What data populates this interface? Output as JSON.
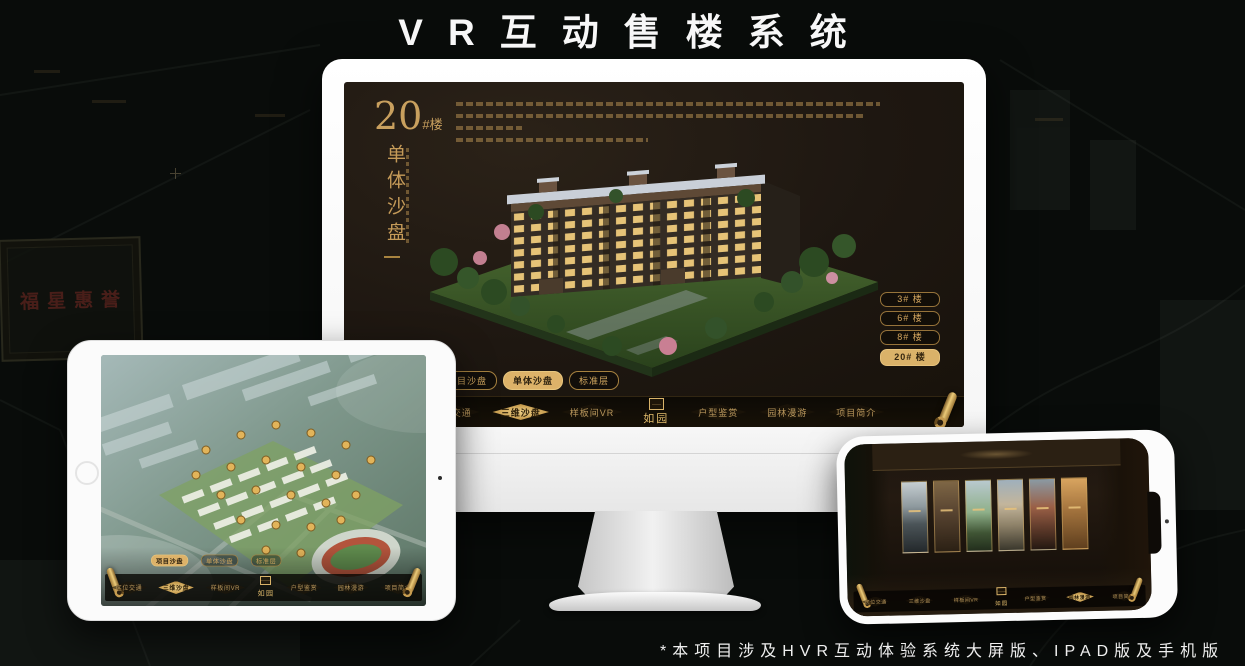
{
  "page": {
    "title": "VR互动售楼系统",
    "footnote": "*本项目涉及HVR互动体验系统大屏版、IPAD版及手机版"
  },
  "colors": {
    "gold_accent": "#C9A05E",
    "gold_fill": "#DAB269",
    "screen_background": "#1E1711",
    "page_background": "#090C0A",
    "title_text": "#F7F7F7"
  },
  "background": {
    "sign_text": "福星惠誉"
  },
  "app": {
    "logo": "如园",
    "tabs": [
      {
        "label": "项目沙盘"
      },
      {
        "label": "单体沙盘"
      },
      {
        "label": "标准层"
      }
    ],
    "nav": [
      {
        "label": "区位交通"
      },
      {
        "label": "三维沙盘"
      },
      {
        "label": "样板间VR"
      },
      {
        "label": "户型鉴赏"
      },
      {
        "label": "园林漫游"
      },
      {
        "label": "项目简介"
      }
    ]
  },
  "monitor": {
    "title_number": "20",
    "title_suffix": "#楼",
    "subtitle": "单体沙盘",
    "selected_tab": "单体沙盘",
    "selected_nav": "三维沙盘",
    "floor_buttons": [
      {
        "label": "3# 楼",
        "selected": false
      },
      {
        "label": "6# 楼",
        "selected": false
      },
      {
        "label": "8# 楼",
        "selected": false
      },
      {
        "label": "20# 楼",
        "selected": true
      }
    ]
  },
  "tablet": {
    "selected_tab": "项目沙盘",
    "selected_nav": "三维沙盘"
  },
  "phone": {
    "selected_nav": "园林漫游",
    "gallery_panel_count": 6
  }
}
